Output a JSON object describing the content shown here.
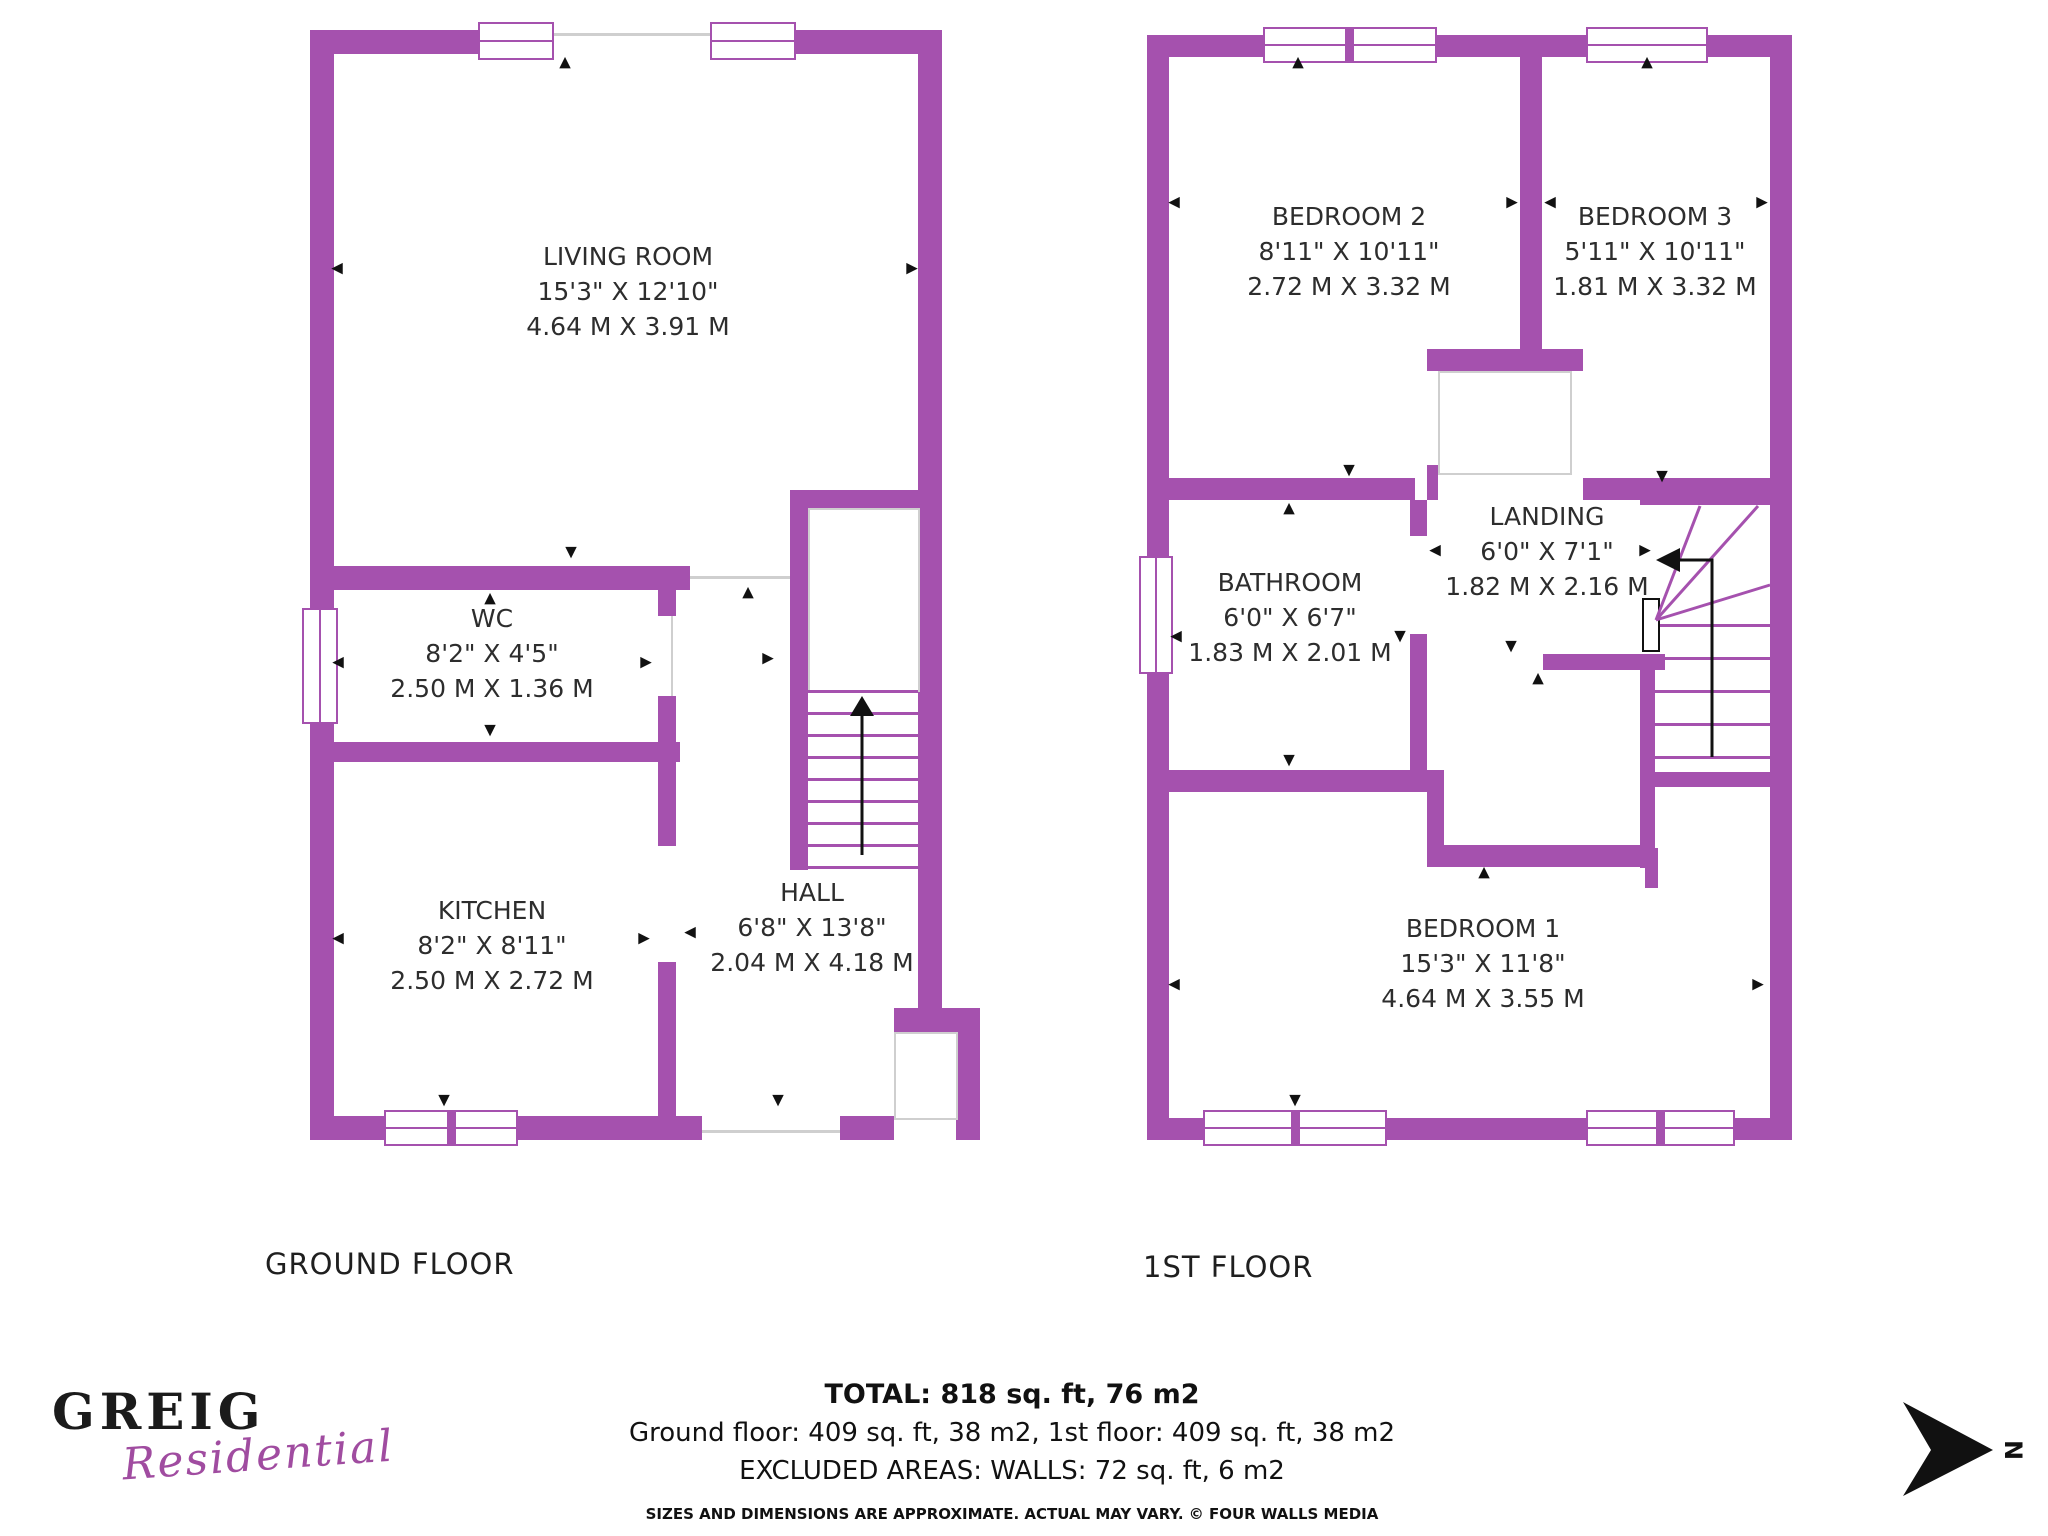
{
  "brand": {
    "line1": "GREIG",
    "line2": "Residential"
  },
  "meta": {
    "north_label": "N"
  },
  "colors": {
    "wall": "#A551AE",
    "thin": "#CFCFCF",
    "logo": "#A04CA0",
    "ink": "#2D2D2D"
  },
  "icons": {
    "up": "▲",
    "down": "▼",
    "left": "◀",
    "right": "▶"
  },
  "floors": [
    {
      "id": "ground",
      "label": "GROUND FLOOR",
      "rooms": [
        {
          "name": "LIVING ROOM",
          "imperial": "15'3\" X 12'10\"",
          "metric": "4.64 M X 3.91 M"
        },
        {
          "name": "WC",
          "imperial": "8'2\" X 4'5\"",
          "metric": "2.50 M X 1.36 M"
        },
        {
          "name": "KITCHEN",
          "imperial": "8'2\" X 8'11\"",
          "metric": "2.50 M X 2.72 M"
        },
        {
          "name": "HALL",
          "imperial": "6'8\" X 13'8\"",
          "metric": "2.04 M X 4.18 M"
        }
      ]
    },
    {
      "id": "first",
      "label": "1ST FLOOR",
      "rooms": [
        {
          "name": "BEDROOM 2",
          "imperial": "8'11\" X 10'11\"",
          "metric": "2.72 M X 3.32 M"
        },
        {
          "name": "BEDROOM 3",
          "imperial": "5'11\" X 10'11\"",
          "metric": "1.81 M X 3.32 M"
        },
        {
          "name": "BATHROOM",
          "imperial": "6'0\" X 6'7\"",
          "metric": "1.83 M X 2.01 M"
        },
        {
          "name": "LANDING",
          "imperial": "6'0\" X 7'1\"",
          "metric": "1.82 M X 2.16 M"
        },
        {
          "name": "BEDROOM 1",
          "imperial": "15'3\" X 11'8\"",
          "metric": "4.64 M X 3.55 M"
        }
      ]
    }
  ],
  "summary": {
    "total": "TOTAL: 818 sq. ft, 76 m2",
    "floors_line": "Ground floor: 409 sq. ft, 38 m2, 1st floor: 409 sq. ft, 38 m2",
    "excluded": "EXCLUDED AREAS: WALLS: 72 sq. ft, 6 m2",
    "disclaimer": "SIZES AND DIMENSIONS ARE APPROXIMATE. ACTUAL MAY VARY. © FOUR WALLS MEDIA"
  }
}
